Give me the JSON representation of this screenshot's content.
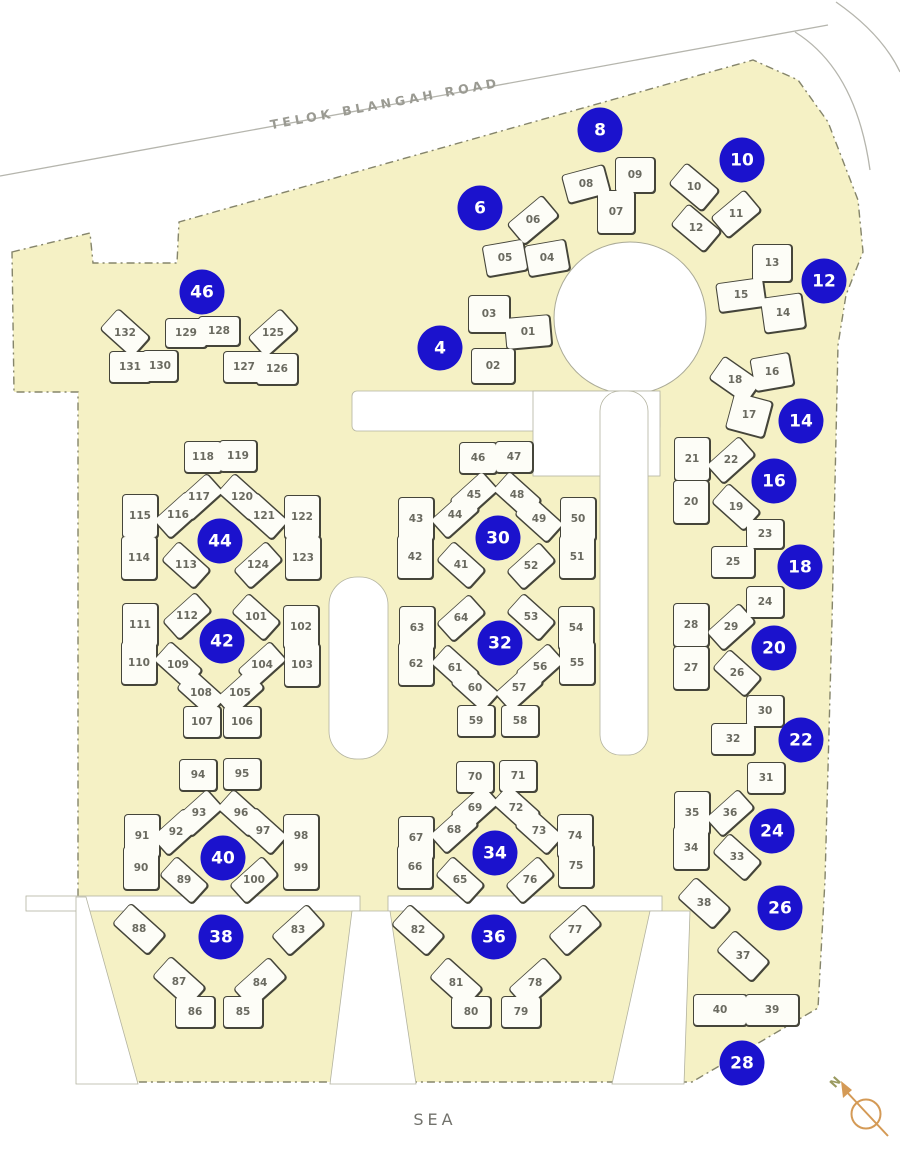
{
  "map": {
    "road_label": "TELOK BLANGAH ROAD",
    "sea_label": "SEA",
    "compass_label": "N",
    "colors": {
      "site_fill": "#f5f1c5",
      "site_boundary": "#85856b",
      "building_fill": "#fdfdf7",
      "building_outline": "#45453a",
      "marker_blue": "#1b12cd",
      "marker_text": "#ffffff",
      "unit_label_gray": "#6a6a60",
      "compass_orange": "#d49a56"
    }
  },
  "block_markers": [
    {
      "number": "4",
      "x": 440,
      "y": 348
    },
    {
      "number": "6",
      "x": 480,
      "y": 208
    },
    {
      "number": "8",
      "x": 600,
      "y": 130
    },
    {
      "number": "10",
      "x": 742,
      "y": 160
    },
    {
      "number": "12",
      "x": 824,
      "y": 281
    },
    {
      "number": "14",
      "x": 801,
      "y": 421
    },
    {
      "number": "16",
      "x": 774,
      "y": 481
    },
    {
      "number": "18",
      "x": 800,
      "y": 567
    },
    {
      "number": "20",
      "x": 774,
      "y": 648
    },
    {
      "number": "22",
      "x": 801,
      "y": 740
    },
    {
      "number": "24",
      "x": 772,
      "y": 831
    },
    {
      "number": "26",
      "x": 780,
      "y": 908
    },
    {
      "number": "28",
      "x": 742,
      "y": 1063
    },
    {
      "number": "30",
      "x": 498,
      "y": 538
    },
    {
      "number": "32",
      "x": 500,
      "y": 643
    },
    {
      "number": "34",
      "x": 495,
      "y": 853
    },
    {
      "number": "36",
      "x": 494,
      "y": 937
    },
    {
      "number": "38",
      "x": 221,
      "y": 937
    },
    {
      "number": "40",
      "x": 223,
      "y": 858
    },
    {
      "number": "42",
      "x": 222,
      "y": 641
    },
    {
      "number": "44",
      "x": 220,
      "y": 541
    },
    {
      "number": "46",
      "x": 202,
      "y": 292
    }
  ],
  "units": [
    {
      "n": "01",
      "x": 528,
      "y": 332,
      "w": 44,
      "h": 30,
      "r": -5
    },
    {
      "n": "02",
      "x": 493,
      "y": 366,
      "w": 42,
      "h": 34
    },
    {
      "n": "03",
      "x": 489,
      "y": 314,
      "w": 40,
      "h": 36
    },
    {
      "n": "04",
      "x": 547,
      "y": 258,
      "r": -10
    },
    {
      "n": "05",
      "x": 505,
      "y": 258,
      "r": -10
    },
    {
      "n": "06",
      "x": 533,
      "y": 220,
      "w": 44,
      "h": 26,
      "r": -40
    },
    {
      "n": "07",
      "x": 616,
      "y": 212,
      "w": 36,
      "h": 42
    },
    {
      "n": "08",
      "x": 586,
      "y": 184,
      "w": 42,
      "h": 28,
      "r": -15
    },
    {
      "n": "09",
      "x": 635,
      "y": 175,
      "w": 38,
      "h": 34
    },
    {
      "n": "10",
      "x": 694,
      "y": 187,
      "w": 42,
      "h": 26,
      "r": 40
    },
    {
      "n": "11",
      "x": 736,
      "y": 214,
      "w": 42,
      "h": 26,
      "r": -40
    },
    {
      "n": "12",
      "x": 696,
      "y": 228,
      "w": 42,
      "h": 26,
      "r": 40
    },
    {
      "n": "13",
      "x": 772,
      "y": 263,
      "w": 38,
      "h": 36
    },
    {
      "n": "14",
      "x": 783,
      "y": 313,
      "w": 40,
      "h": 34,
      "r": -8
    },
    {
      "n": "15",
      "x": 741,
      "y": 295,
      "w": 46,
      "h": 28,
      "r": -8
    },
    {
      "n": "16",
      "x": 772,
      "y": 372,
      "w": 38,
      "h": 32,
      "r": -10
    },
    {
      "n": "17",
      "x": 749,
      "y": 415,
      "w": 38,
      "h": 36,
      "r": 15
    },
    {
      "n": "18",
      "x": 735,
      "y": 380,
      "w": 44,
      "h": 26,
      "r": 35
    },
    {
      "n": "19",
      "x": 736,
      "y": 507,
      "w": 42,
      "h": 24,
      "r": 42
    },
    {
      "n": "20",
      "x": 691,
      "y": 502,
      "w": 34,
      "h": 42
    },
    {
      "n": "21",
      "x": 692,
      "y": 459,
      "w": 34,
      "h": 42
    },
    {
      "n": "22",
      "x": 731,
      "y": 460,
      "w": 42,
      "h": 24,
      "r": -42
    },
    {
      "n": "23",
      "x": 765,
      "y": 534,
      "w": 36,
      "h": 28
    },
    {
      "n": "24",
      "x": 765,
      "y": 602,
      "w": 36,
      "h": 30
    },
    {
      "n": "25",
      "x": 733,
      "y": 562,
      "w": 42,
      "h": 30
    },
    {
      "n": "26",
      "x": 737,
      "y": 673,
      "w": 42,
      "h": 24,
      "r": 42
    },
    {
      "n": "27",
      "x": 691,
      "y": 668,
      "w": 34,
      "h": 42
    },
    {
      "n": "28",
      "x": 691,
      "y": 625,
      "w": 34,
      "h": 42
    },
    {
      "n": "29",
      "x": 731,
      "y": 627,
      "w": 42,
      "h": 24,
      "r": -42
    },
    {
      "n": "30",
      "x": 765,
      "y": 711,
      "w": 36,
      "h": 30
    },
    {
      "n": "31",
      "x": 766,
      "y": 778,
      "w": 36,
      "h": 30
    },
    {
      "n": "32",
      "x": 733,
      "y": 739,
      "w": 42,
      "h": 30
    },
    {
      "n": "33",
      "x": 737,
      "y": 857,
      "w": 42,
      "h": 24,
      "r": 42
    },
    {
      "n": "34",
      "x": 691,
      "y": 848,
      "w": 34,
      "h": 42
    },
    {
      "n": "35",
      "x": 692,
      "y": 813,
      "w": 34,
      "h": 42
    },
    {
      "n": "36",
      "x": 730,
      "y": 813,
      "w": 42,
      "h": 24,
      "r": -42
    },
    {
      "n": "37",
      "x": 743,
      "y": 956,
      "w": 46,
      "h": 26,
      "r": 42
    },
    {
      "n": "38",
      "x": 704,
      "y": 903,
      "w": 46,
      "h": 26,
      "r": 42
    },
    {
      "n": "39",
      "x": 772,
      "y": 1010,
      "w": 52,
      "h": 30
    },
    {
      "n": "40",
      "x": 720,
      "y": 1010,
      "w": 52,
      "h": 30
    },
    {
      "n": "41",
      "x": 461,
      "y": 565,
      "w": 42,
      "h": 24,
      "r": 42
    },
    {
      "n": "42",
      "x": 415,
      "y": 557,
      "w": 34,
      "h": 42
    },
    {
      "n": "43",
      "x": 416,
      "y": 519,
      "w": 34,
      "h": 42
    },
    {
      "n": "44",
      "x": 455,
      "y": 515,
      "w": 42,
      "h": 24,
      "r": -42
    },
    {
      "n": "45",
      "x": 474,
      "y": 495,
      "w": 42,
      "h": 24,
      "r": -42
    },
    {
      "n": "46",
      "x": 478,
      "y": 458,
      "w": 36,
      "h": 30
    },
    {
      "n": "47",
      "x": 514,
      "y": 457,
      "w": 36,
      "h": 30
    },
    {
      "n": "48",
      "x": 517,
      "y": 495,
      "w": 42,
      "h": 24,
      "r": 42
    },
    {
      "n": "49",
      "x": 539,
      "y": 519,
      "w": 42,
      "h": 24,
      "r": 42
    },
    {
      "n": "50",
      "x": 578,
      "y": 519,
      "w": 34,
      "h": 42
    },
    {
      "n": "51",
      "x": 577,
      "y": 557,
      "w": 34,
      "h": 42
    },
    {
      "n": "52",
      "x": 531,
      "y": 566,
      "w": 42,
      "h": 24,
      "r": -42
    },
    {
      "n": "53",
      "x": 531,
      "y": 617,
      "w": 42,
      "h": 24,
      "r": 42
    },
    {
      "n": "54",
      "x": 576,
      "y": 628,
      "w": 34,
      "h": 42
    },
    {
      "n": "55",
      "x": 577,
      "y": 663,
      "w": 34,
      "h": 42
    },
    {
      "n": "56",
      "x": 540,
      "y": 667,
      "w": 42,
      "h": 24,
      "r": -42
    },
    {
      "n": "57",
      "x": 519,
      "y": 688,
      "w": 42,
      "h": 24,
      "r": -42
    },
    {
      "n": "58",
      "x": 520,
      "y": 721,
      "w": 36,
      "h": 30
    },
    {
      "n": "59",
      "x": 476,
      "y": 721,
      "w": 36,
      "h": 30
    },
    {
      "n": "60",
      "x": 475,
      "y": 688,
      "w": 42,
      "h": 24,
      "r": 42
    },
    {
      "n": "61",
      "x": 455,
      "y": 668,
      "w": 42,
      "h": 24,
      "r": 42
    },
    {
      "n": "62",
      "x": 416,
      "y": 664,
      "w": 34,
      "h": 42
    },
    {
      "n": "63",
      "x": 417,
      "y": 628,
      "w": 34,
      "h": 42
    },
    {
      "n": "64",
      "x": 461,
      "y": 618,
      "w": 42,
      "h": 24,
      "r": -42
    },
    {
      "n": "65",
      "x": 460,
      "y": 880,
      "w": 42,
      "h": 24,
      "r": 42
    },
    {
      "n": "66",
      "x": 415,
      "y": 867,
      "w": 34,
      "h": 42
    },
    {
      "n": "67",
      "x": 416,
      "y": 838,
      "w": 34,
      "h": 42
    },
    {
      "n": "68",
      "x": 454,
      "y": 830,
      "w": 42,
      "h": 24,
      "r": -42
    },
    {
      "n": "69",
      "x": 475,
      "y": 808,
      "w": 42,
      "h": 24,
      "r": -42
    },
    {
      "n": "70",
      "x": 475,
      "y": 777,
      "w": 36,
      "h": 30
    },
    {
      "n": "71",
      "x": 518,
      "y": 776,
      "w": 36,
      "h": 30
    },
    {
      "n": "72",
      "x": 516,
      "y": 808,
      "w": 42,
      "h": 24,
      "r": 42
    },
    {
      "n": "73",
      "x": 539,
      "y": 831,
      "w": 42,
      "h": 24,
      "r": 42
    },
    {
      "n": "74",
      "x": 575,
      "y": 836,
      "w": 34,
      "h": 42
    },
    {
      "n": "75",
      "x": 576,
      "y": 866,
      "w": 34,
      "h": 42
    },
    {
      "n": "76",
      "x": 530,
      "y": 880,
      "w": 42,
      "h": 24,
      "r": -42
    },
    {
      "n": "77",
      "x": 575,
      "y": 930,
      "w": 46,
      "h": 26,
      "r": -42
    },
    {
      "n": "78",
      "x": 535,
      "y": 983,
      "w": 46,
      "h": 26,
      "r": -42
    },
    {
      "n": "79",
      "x": 521,
      "y": 1012,
      "w": 38,
      "h": 30
    },
    {
      "n": "80",
      "x": 471,
      "y": 1012,
      "w": 38,
      "h": 30
    },
    {
      "n": "81",
      "x": 456,
      "y": 983,
      "w": 46,
      "h": 26,
      "r": 42
    },
    {
      "n": "82",
      "x": 418,
      "y": 930,
      "w": 46,
      "h": 26,
      "r": 42
    },
    {
      "n": "83",
      "x": 298,
      "y": 930,
      "w": 46,
      "h": 26,
      "r": -42
    },
    {
      "n": "84",
      "x": 260,
      "y": 983,
      "w": 46,
      "h": 26,
      "r": -42
    },
    {
      "n": "85",
      "x": 243,
      "y": 1012,
      "w": 38,
      "h": 30
    },
    {
      "n": "86",
      "x": 195,
      "y": 1012,
      "w": 38,
      "h": 30
    },
    {
      "n": "87",
      "x": 179,
      "y": 982,
      "w": 46,
      "h": 26,
      "r": 42
    },
    {
      "n": "88",
      "x": 139,
      "y": 929,
      "w": 46,
      "h": 26,
      "r": 42
    },
    {
      "n": "89",
      "x": 184,
      "y": 880,
      "w": 42,
      "h": 24,
      "r": 42
    },
    {
      "n": "90",
      "x": 141,
      "y": 868,
      "w": 34,
      "h": 42
    },
    {
      "n": "91",
      "x": 142,
      "y": 836,
      "w": 34,
      "h": 42
    },
    {
      "n": "92",
      "x": 176,
      "y": 832,
      "w": 42,
      "h": 24,
      "r": -42
    },
    {
      "n": "93",
      "x": 199,
      "y": 813,
      "w": 42,
      "h": 24,
      "r": -42
    },
    {
      "n": "94",
      "x": 198,
      "y": 775,
      "w": 36,
      "h": 30
    },
    {
      "n": "95",
      "x": 242,
      "y": 774,
      "w": 36,
      "h": 30
    },
    {
      "n": "96",
      "x": 241,
      "y": 813,
      "w": 42,
      "h": 24,
      "r": 42
    },
    {
      "n": "97",
      "x": 263,
      "y": 831,
      "w": 42,
      "h": 24,
      "r": 42
    },
    {
      "n": "98",
      "x": 301,
      "y": 836,
      "w": 34,
      "h": 42
    },
    {
      "n": "99",
      "x": 301,
      "y": 868,
      "w": 34,
      "h": 42
    },
    {
      "n": "100",
      "x": 254,
      "y": 880,
      "w": 42,
      "h": 24,
      "r": -42
    },
    {
      "n": "101",
      "x": 256,
      "y": 617,
      "w": 42,
      "h": 24,
      "r": 42
    },
    {
      "n": "102",
      "x": 301,
      "y": 627,
      "w": 34,
      "h": 42
    },
    {
      "n": "103",
      "x": 302,
      "y": 665,
      "w": 34,
      "h": 42
    },
    {
      "n": "104",
      "x": 262,
      "y": 665,
      "w": 42,
      "h": 24,
      "r": -42
    },
    {
      "n": "105",
      "x": 240,
      "y": 693,
      "w": 42,
      "h": 24,
      "r": -42
    },
    {
      "n": "106",
      "x": 242,
      "y": 722,
      "w": 36,
      "h": 30
    },
    {
      "n": "107",
      "x": 202,
      "y": 722,
      "w": 36,
      "h": 30
    },
    {
      "n": "108",
      "x": 201,
      "y": 693,
      "w": 42,
      "h": 24,
      "r": 42
    },
    {
      "n": "109",
      "x": 178,
      "y": 665,
      "w": 42,
      "h": 24,
      "r": 42
    },
    {
      "n": "110",
      "x": 139,
      "y": 663,
      "w": 34,
      "h": 42
    },
    {
      "n": "111",
      "x": 140,
      "y": 625,
      "w": 34,
      "h": 42
    },
    {
      "n": "112",
      "x": 187,
      "y": 616,
      "w": 42,
      "h": 24,
      "r": -42
    },
    {
      "n": "113",
      "x": 186,
      "y": 565,
      "w": 42,
      "h": 24,
      "r": 42
    },
    {
      "n": "114",
      "x": 139,
      "y": 558,
      "w": 34,
      "h": 42
    },
    {
      "n": "115",
      "x": 140,
      "y": 516,
      "w": 34,
      "h": 42
    },
    {
      "n": "116",
      "x": 178,
      "y": 515,
      "w": 42,
      "h": 24,
      "r": -42
    },
    {
      "n": "117",
      "x": 199,
      "y": 497,
      "w": 42,
      "h": 24,
      "r": -42
    },
    {
      "n": "118",
      "x": 203,
      "y": 457,
      "w": 36,
      "h": 30
    },
    {
      "n": "119",
      "x": 238,
      "y": 456,
      "w": 36,
      "h": 30
    },
    {
      "n": "120",
      "x": 242,
      "y": 497,
      "w": 42,
      "h": 24,
      "r": 42
    },
    {
      "n": "121",
      "x": 264,
      "y": 516,
      "w": 42,
      "h": 24,
      "r": 42
    },
    {
      "n": "122",
      "x": 302,
      "y": 517,
      "w": 34,
      "h": 42
    },
    {
      "n": "123",
      "x": 303,
      "y": 558,
      "w": 34,
      "h": 42
    },
    {
      "n": "124",
      "x": 258,
      "y": 565,
      "w": 42,
      "h": 24,
      "r": -42
    },
    {
      "n": "125",
      "x": 273,
      "y": 333,
      "w": 42,
      "h": 26,
      "r": -42
    },
    {
      "n": "126",
      "x": 277,
      "y": 369,
      "w": 40,
      "h": 30
    },
    {
      "n": "127",
      "x": 244,
      "y": 367,
      "w": 40,
      "h": 30
    },
    {
      "n": "128",
      "x": 219,
      "y": 331,
      "w": 40,
      "h": 28
    },
    {
      "n": "129",
      "x": 186,
      "y": 333,
      "w": 40,
      "h": 28
    },
    {
      "n": "130",
      "x": 160,
      "y": 366,
      "w": 34,
      "h": 30
    },
    {
      "n": "131",
      "x": 130,
      "y": 367,
      "w": 40,
      "h": 30
    },
    {
      "n": "132",
      "x": 125,
      "y": 333,
      "w": 42,
      "h": 26,
      "r": 42
    }
  ]
}
